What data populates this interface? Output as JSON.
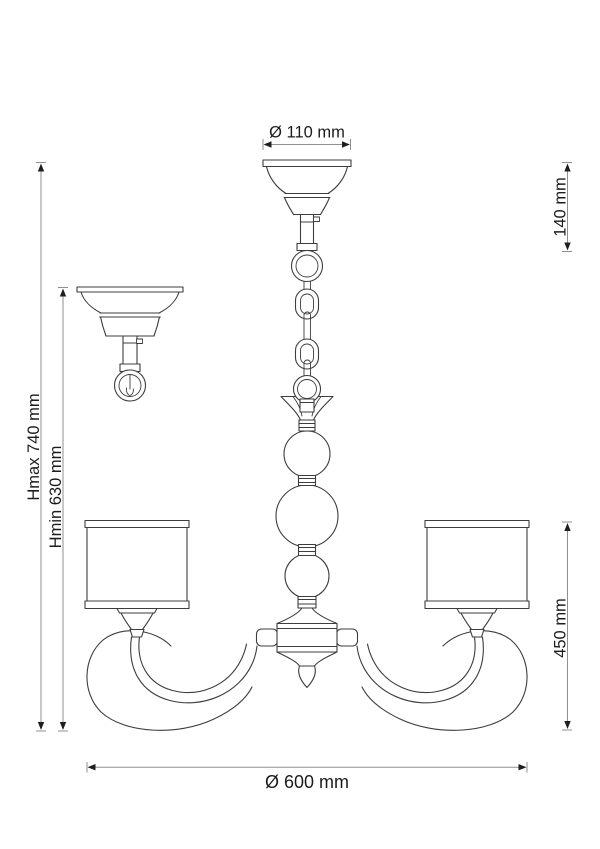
{
  "drawing": {
    "dimension_labels": {
      "canopy_diameter": "Ø 110 mm",
      "suspension_height": "140 mm",
      "max_height": "Hmax 740 mm",
      "min_height": "Hmin 630 mm",
      "body_height": "450 mm",
      "overall_diameter": "Ø 600 mm"
    },
    "colors": {
      "background": "#ffffff",
      "outline": "#3d3d3d",
      "dimension_line": "#8f8f8f",
      "arrowhead": "#1f1f1f",
      "text": "#1c1c1c"
    }
  }
}
